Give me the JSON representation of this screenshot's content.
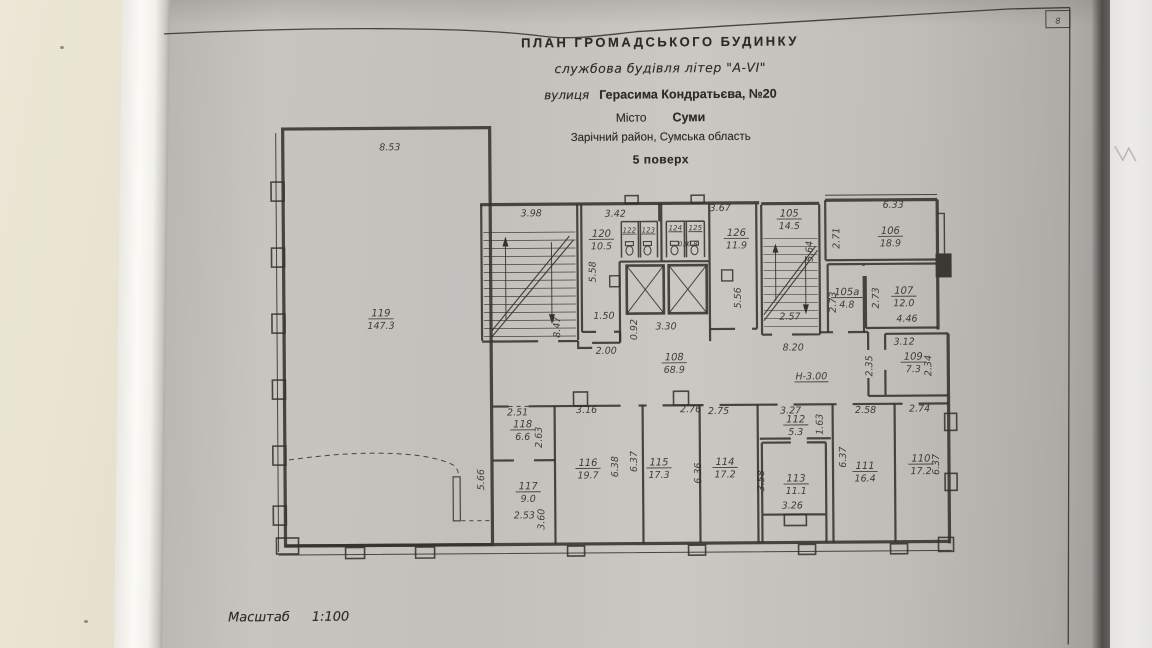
{
  "document": {
    "title": "ПЛАН  ГРОМАДСЬКОГО  БУДИНКУ",
    "subtitle": "службова будівля літер \"А-VI\"",
    "street_label": "вулиця",
    "street_value": "Герасима Кондратьєва, №20",
    "city_label": "Місто",
    "city_value": "Суми",
    "district": "Зарічний район, Сумська область",
    "floor": "5 поверх",
    "scale_label": "Масштаб",
    "scale_value": "1:100",
    "corner_mark": "8"
  },
  "rooms": [
    {
      "n": "119",
      "a": "147.3",
      "x": 381,
      "y": 315
    },
    {
      "n": "120",
      "a": "10.5",
      "x": 602,
      "y": 237
    },
    {
      "n": "126",
      "a": "11.9",
      "x": 737,
      "y": 237
    },
    {
      "n": "105",
      "a": "14.5",
      "x": 790,
      "y": 218
    },
    {
      "n": "106",
      "a": "18.9",
      "x": 891,
      "y": 236
    },
    {
      "n": "105а",
      "a": "4.8",
      "x": 847,
      "y": 297
    },
    {
      "n": "107",
      "a": "12.0",
      "x": 904,
      "y": 296
    },
    {
      "n": "108",
      "a": "68.9",
      "x": 674,
      "y": 361
    },
    {
      "n": "109",
      "a": "7.3",
      "x": 913,
      "y": 362
    },
    {
      "n": "118",
      "a": "6.6",
      "x": 522,
      "y": 427
    },
    {
      "n": "117",
      "a": "9.0",
      "x": 527,
      "y": 489
    },
    {
      "n": "116",
      "a": "19.7",
      "x": 587,
      "y": 466
    },
    {
      "n": "115",
      "a": "17.3",
      "x": 658,
      "y": 466
    },
    {
      "n": "114",
      "a": "17.2",
      "x": 724,
      "y": 466
    },
    {
      "n": "112",
      "a": "5.3",
      "x": 795,
      "y": 424
    },
    {
      "n": "113",
      "a": "11.1",
      "x": 795,
      "y": 483
    },
    {
      "n": "111",
      "a": "16.4",
      "x": 864,
      "y": 471
    },
    {
      "n": "110",
      "a": "17.2",
      "x": 920,
      "y": 464
    }
  ],
  "wc_stalls": [
    {
      "n": "122",
      "x": 630,
      "y": 233
    },
    {
      "n": "123",
      "x": 649,
      "y": 233
    },
    {
      "n": "124",
      "a": "0.9",
      "x": 676,
      "y": 231,
      "ax": 684,
      "ay": 247
    },
    {
      "n": "125",
      "a": "0.8",
      "x": 696,
      "y": 231,
      "ax": 693,
      "ay": 247
    }
  ],
  "dimensions": [
    {
      "t": "8.53",
      "x": 391,
      "y": 149
    },
    {
      "t": "3.98",
      "x": 532,
      "y": 216
    },
    {
      "t": "3.42",
      "x": 616,
      "y": 217
    },
    {
      "t": "3.67",
      "x": 721,
      "y": 212
    },
    {
      "t": "6.33",
      "x": 894,
      "y": 210
    },
    {
      "t": "2.71",
      "x": 840,
      "y": 240,
      "r": 1
    },
    {
      "t": "5.58",
      "x": 596,
      "y": 272,
      "r": 1
    },
    {
      "t": "5.64",
      "x": 813,
      "y": 253,
      "r": 1
    },
    {
      "t": "5.56",
      "x": 741,
      "y": 299,
      "r": 1
    },
    {
      "t": "8.47",
      "x": 560,
      "y": 327,
      "r": 1
    },
    {
      "t": "1.50",
      "x": 604,
      "y": 319
    },
    {
      "t": "0.92",
      "x": 637,
      "y": 330,
      "r": 1
    },
    {
      "t": "3.30",
      "x": 666,
      "y": 330
    },
    {
      "t": "2.57",
      "x": 790,
      "y": 321
    },
    {
      "t": "2.73",
      "x": 836,
      "y": 304,
      "r": 1
    },
    {
      "t": "2.73",
      "x": 879,
      "y": 300,
      "r": 1
    },
    {
      "t": "4.46",
      "x": 907,
      "y": 324
    },
    {
      "t": "2.00",
      "x": 606,
      "y": 354
    },
    {
      "t": "8.20",
      "x": 793,
      "y": 352
    },
    {
      "t": "Н-3.00",
      "x": 811,
      "y": 381,
      "u": 1
    },
    {
      "t": "2.35",
      "x": 872,
      "y": 368,
      "r": 1
    },
    {
      "t": "3.12",
      "x": 904,
      "y": 347
    },
    {
      "t": "2.34",
      "x": 931,
      "y": 368,
      "r": 1
    },
    {
      "t": "2.51",
      "x": 517,
      "y": 415
    },
    {
      "t": "2.63",
      "x": 541,
      "y": 437,
      "r": 1
    },
    {
      "t": "3.16",
      "x": 586,
      "y": 413
    },
    {
      "t": "2.76",
      "x": 690,
      "y": 413
    },
    {
      "t": "2.75",
      "x": 718,
      "y": 415
    },
    {
      "t": "3.27",
      "x": 790,
      "y": 415
    },
    {
      "t": "2.58",
      "x": 865,
      "y": 415
    },
    {
      "t": "2.74",
      "x": 919,
      "y": 414
    },
    {
      "t": "1.63",
      "x": 822,
      "y": 426,
      "r": 1
    },
    {
      "t": "5.66",
      "x": 483,
      "y": 479,
      "r": 1
    },
    {
      "t": "3.60",
      "x": 543,
      "y": 519,
      "r": 1
    },
    {
      "t": "2.53",
      "x": 523,
      "y": 518
    },
    {
      "t": "6.38",
      "x": 617,
      "y": 467,
      "r": 1
    },
    {
      "t": "6.37",
      "x": 636,
      "y": 462,
      "r": 1
    },
    {
      "t": "6.36",
      "x": 700,
      "y": 474,
      "r": 1
    },
    {
      "t": "3.58",
      "x": 763,
      "y": 482,
      "r": 1
    },
    {
      "t": "3.26",
      "x": 791,
      "y": 510
    },
    {
      "t": "6.37",
      "x": 845,
      "y": 459,
      "r": 1
    },
    {
      "t": "6.37",
      "x": 938,
      "y": 467,
      "r": 1
    }
  ]
}
